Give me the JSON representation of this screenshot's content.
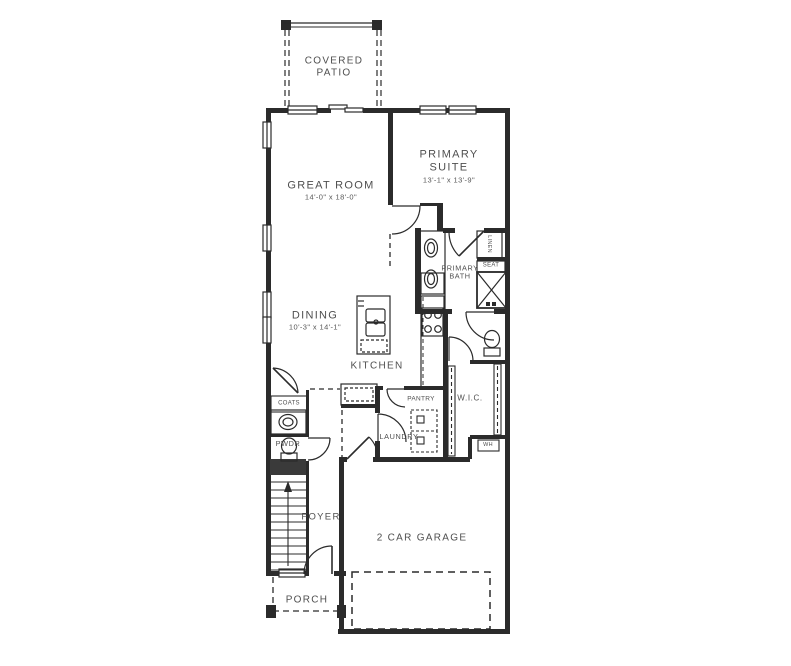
{
  "page": {
    "background": "#ffffff"
  },
  "drawing": {
    "line_color": "#2b2b2b",
    "text_color": "#4f4f4f"
  },
  "rooms": {
    "covered_patio": {
      "line1": "COVERED",
      "line2": "PATIO"
    },
    "great_room": {
      "name": "GREAT ROOM",
      "dims": "14'-0\" x 18'-0\""
    },
    "primary_suite": {
      "line1": "PRIMARY",
      "line2": "SUITE",
      "dims": "13'-1\" x 13'-9\""
    },
    "dining": {
      "name": "DINING",
      "dims": "10'-3\" x 14'-1\""
    },
    "kitchen": {
      "name": "KITCHEN"
    },
    "primary_bath": {
      "line1": "PRIMARY",
      "line2": "BATH"
    },
    "pantry": {
      "name": "PANTRY"
    },
    "laundry": {
      "name": "LAUNDRY"
    },
    "wic": {
      "name": "W.I.C."
    },
    "pwdr": {
      "name": "PWDR"
    },
    "foyer": {
      "name": "FOYER"
    },
    "coats": {
      "name": "COATS"
    },
    "seat": {
      "name": "SEAT"
    },
    "linen": {
      "name": "LINEN"
    },
    "water_heater": {
      "name": "WH"
    },
    "garage": {
      "name": "2 CAR GARAGE"
    },
    "porch": {
      "name": "PORCH"
    }
  }
}
